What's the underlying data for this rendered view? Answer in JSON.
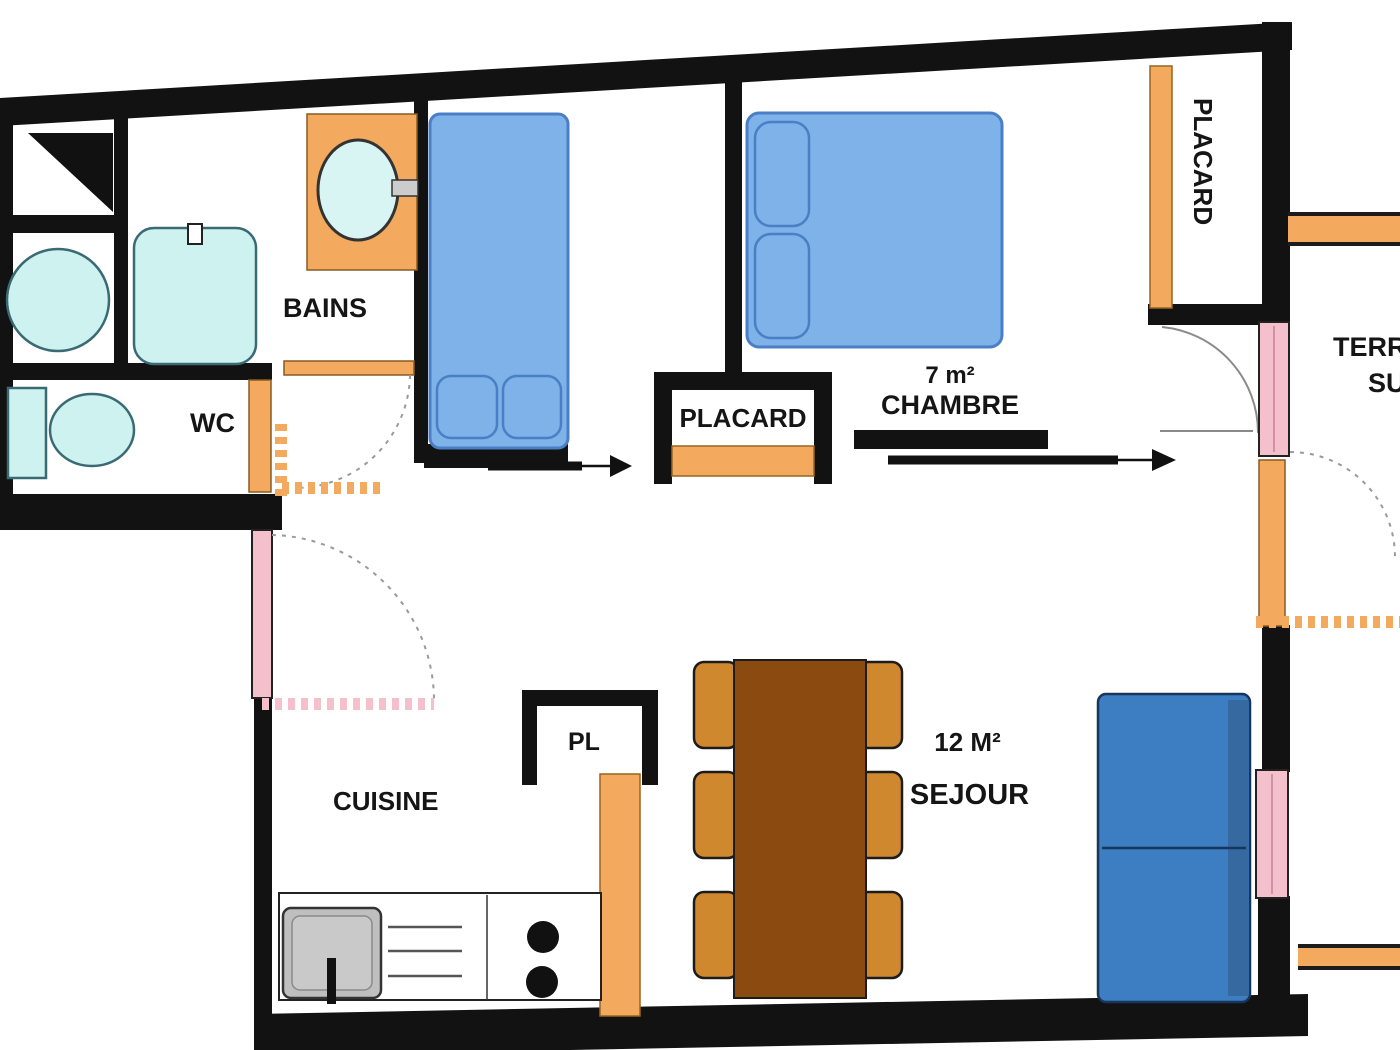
{
  "rooms": {
    "bains": {
      "label": "BAINS"
    },
    "wc": {
      "label": "WC"
    },
    "cuisine": {
      "label": "CUISINE"
    },
    "chambre": {
      "label": "CHAMBRE",
      "area": "7 m²"
    },
    "sejour": {
      "label": "SEJOUR",
      "area": "12 M²"
    },
    "pl": {
      "label": "PL"
    },
    "placard_hall": {
      "label": "PLACARD"
    },
    "placard_entry": {
      "label": "PLACARD"
    },
    "terrasse": {
      "line1": "TERRASSE",
      "line2": "SUD"
    }
  },
  "colors": {
    "c-wall": "#121212",
    "c-window": "#f4c0cc",
    "c-door": "#f3a95e",
    "c-table": "#8a4a10",
    "c-chair": "#d0882f",
    "c-bed": "#7eb2e8",
    "c-bedline": "#4a7fc5",
    "c-sofa": "#3d7dc2",
    "c-sofadark": "#17365c",
    "c-fixture": "#cdf2f0",
    "c-fixstroke": "#3a6a74",
    "c-sink": "#bfbfbf"
  }
}
